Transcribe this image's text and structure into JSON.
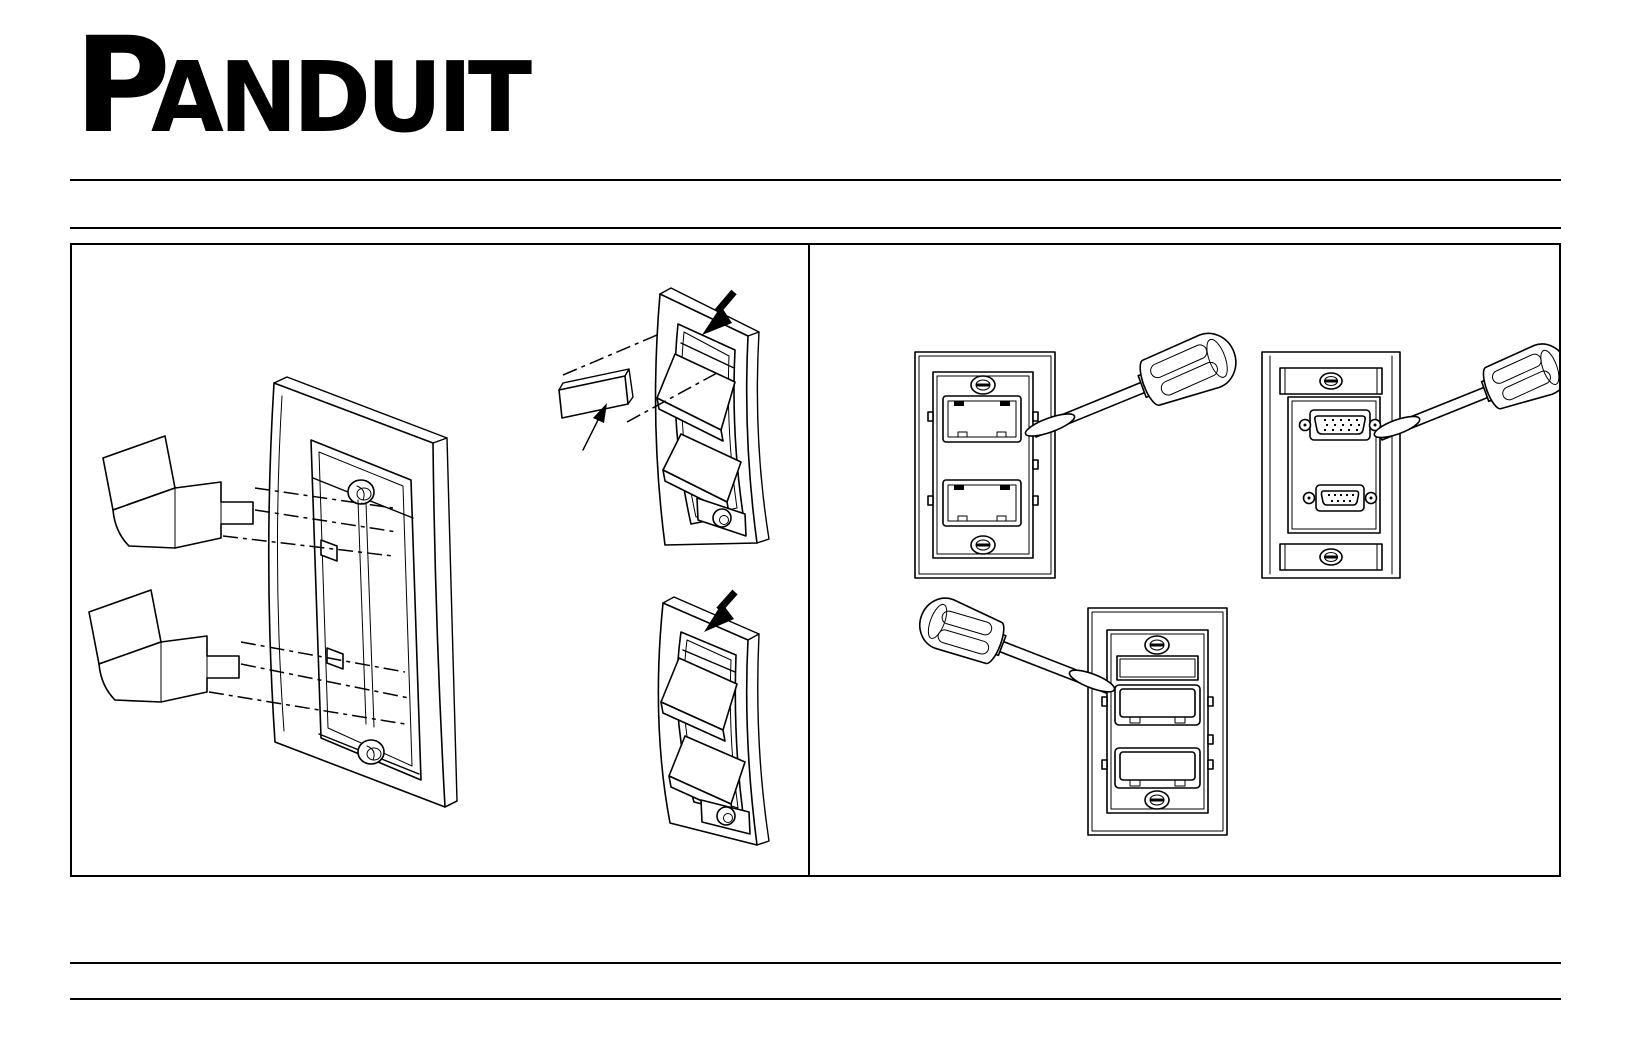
{
  "brand": {
    "logo_text": "PANDUIT",
    "logo_first_letter": "P",
    "logo_rest": "ANDUIT"
  },
  "palette": {
    "ink": "#000000",
    "paper": "#ffffff"
  },
  "figures": [
    {
      "name": "modules-into-faceplate-rear-diagram",
      "panel": "left"
    },
    {
      "name": "label-strip-removal-diagram",
      "panel": "left"
    },
    {
      "name": "shuttered-faceplate-tilted-diagram",
      "panel": "left"
    },
    {
      "name": "screwdriver-prying-jack-module-faceplate-diagram",
      "panel": "right"
    },
    {
      "name": "screwdriver-prying-vga-db9-faceplate-diagram",
      "panel": "right"
    },
    {
      "name": "screwdriver-prying-shuttered-faceplate-diagram",
      "panel": "right"
    }
  ]
}
